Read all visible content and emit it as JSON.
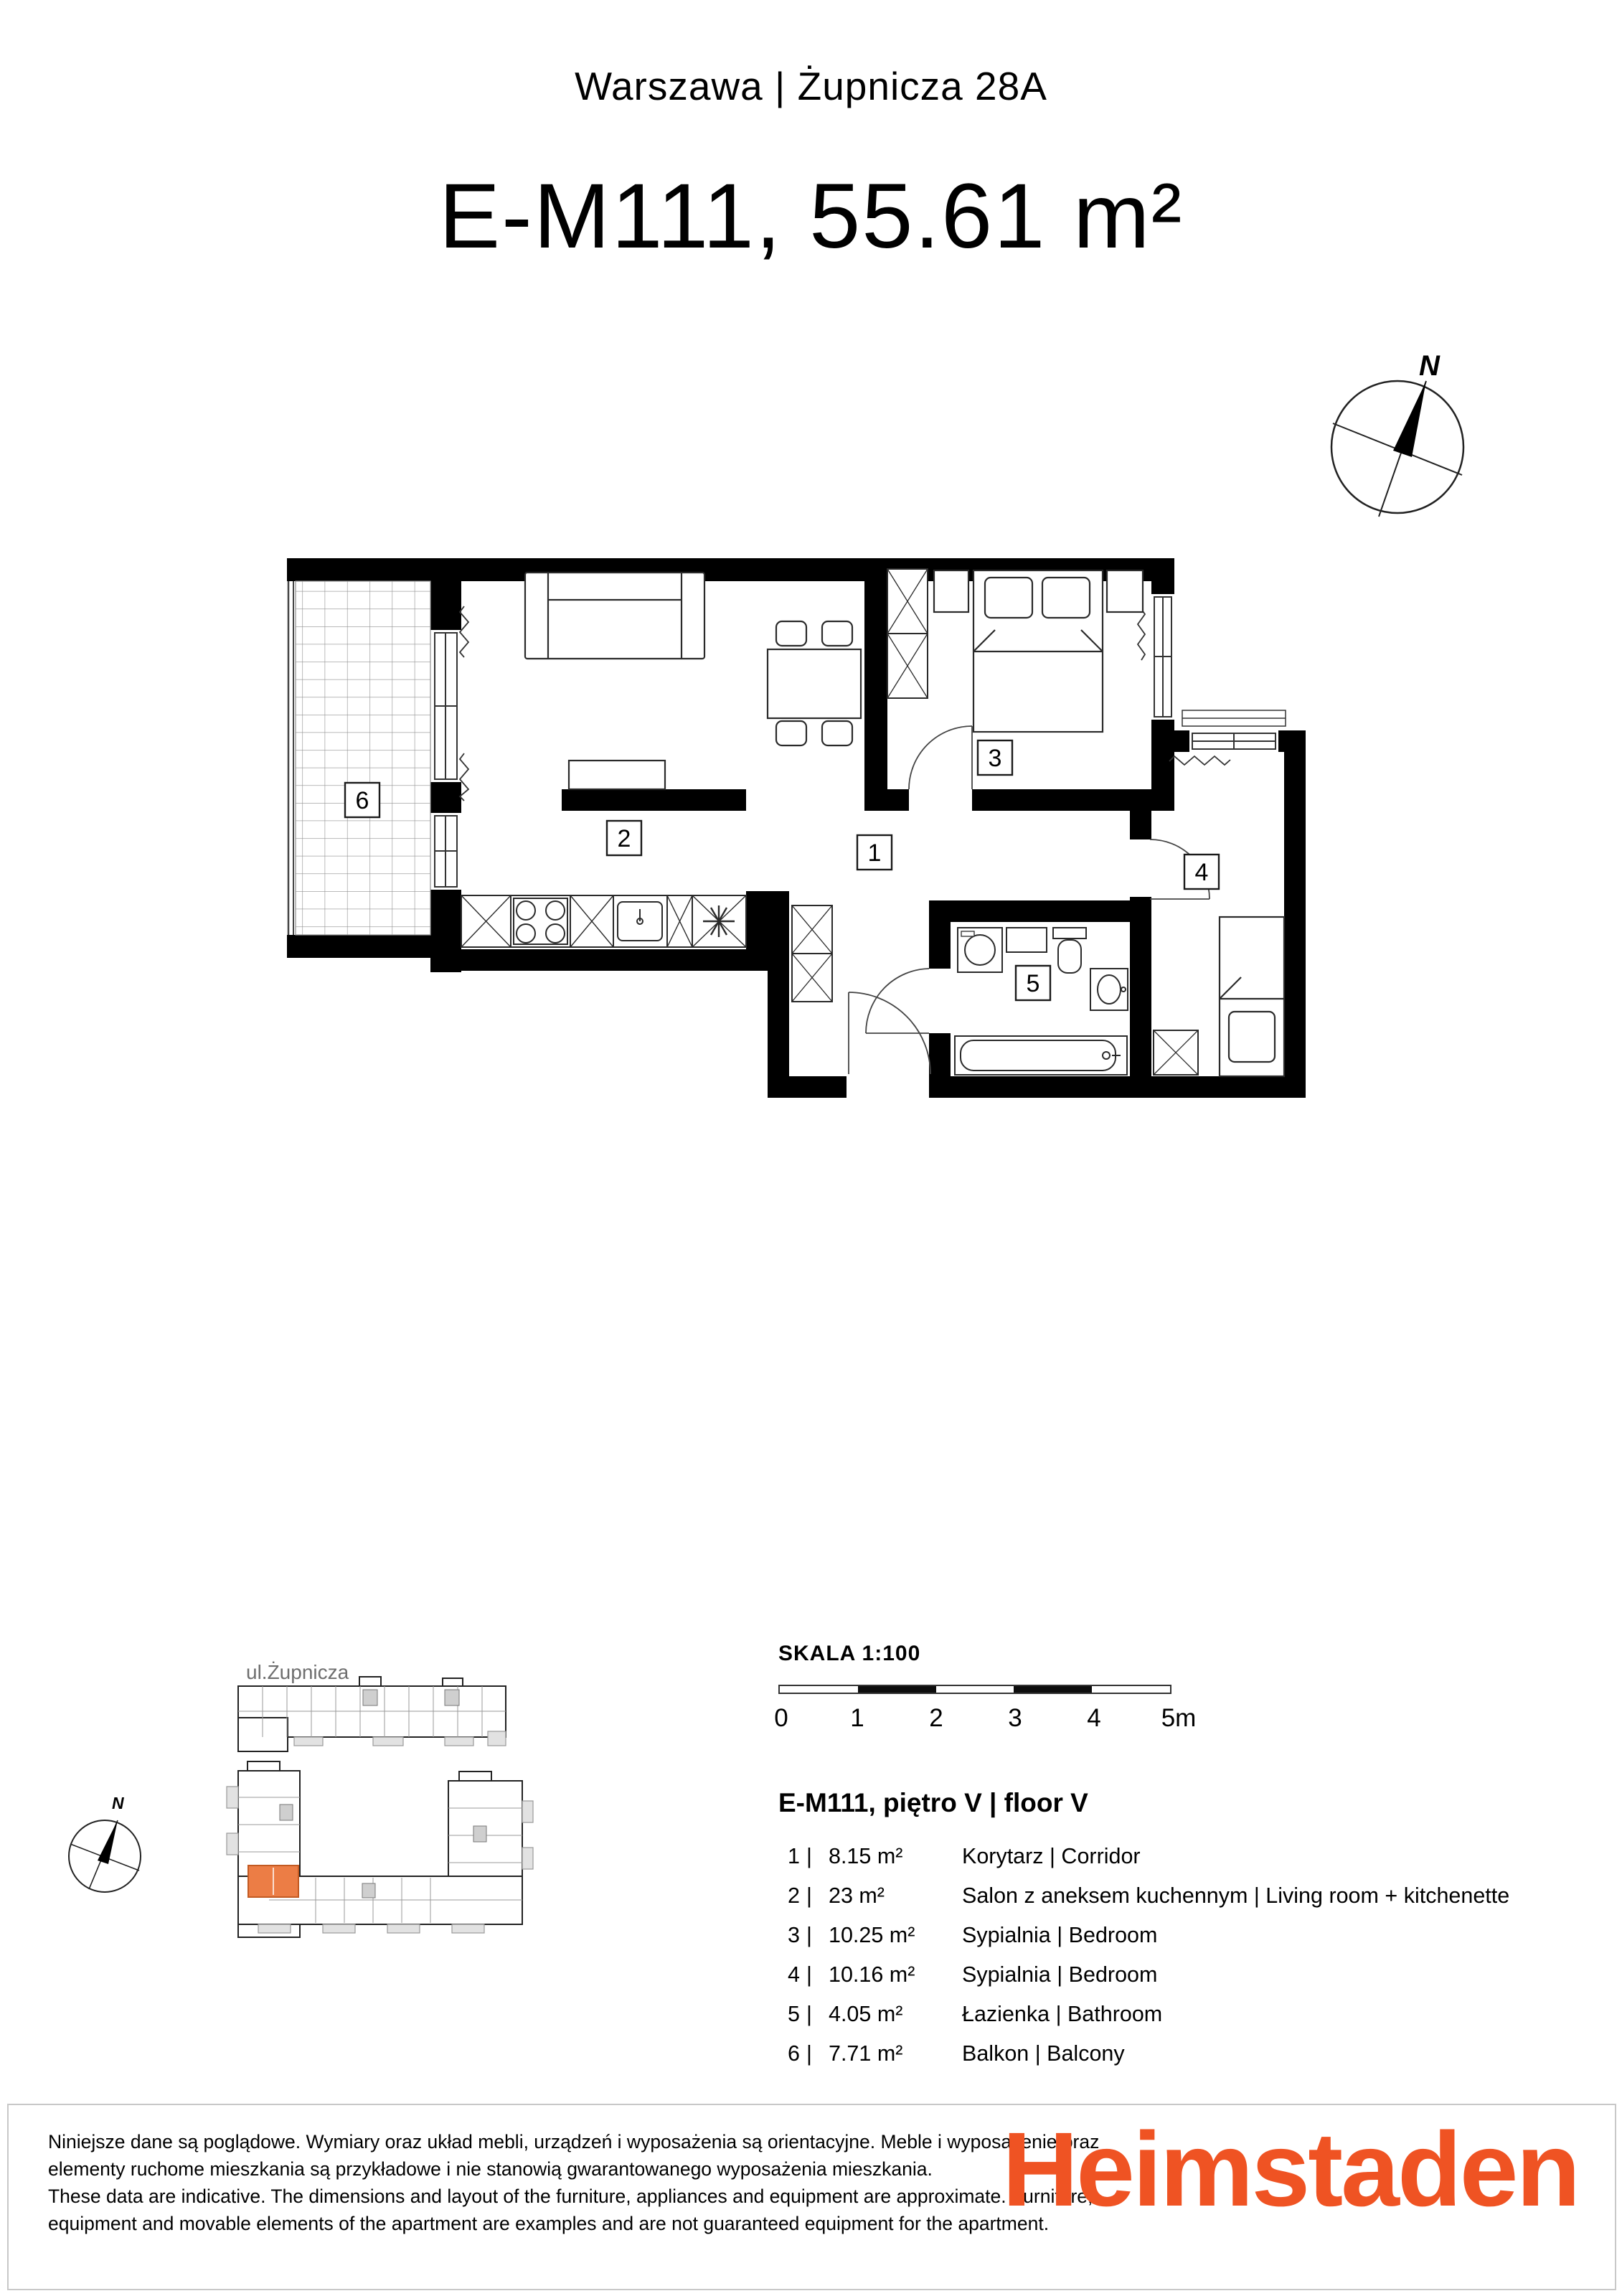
{
  "header": {
    "subtitle": "Warszawa | Żupnicza 28A",
    "title": "E-M111, 55.61 m²"
  },
  "compass": {
    "n": "N"
  },
  "plan": {
    "room_labels": [
      "1",
      "2",
      "3",
      "4",
      "5",
      "6"
    ]
  },
  "minimap": {
    "street": "ul.Żupnicza",
    "n": "N",
    "highlight_color": "#EC7D45"
  },
  "scale": {
    "title": "SKALA 1:100",
    "ticks": [
      "0",
      "1",
      "2",
      "3",
      "4",
      "5m"
    ]
  },
  "legend": {
    "heading": "E-M111, piętro V | floor V",
    "divider": "|",
    "rooms": [
      {
        "n": "1",
        "area": "8.15 m²",
        "name": "Korytarz  | Corridor"
      },
      {
        "n": "2",
        "area": "23 m²",
        "name": "Salon z aneksem kuchennym  | Living room + kitchenette"
      },
      {
        "n": "3",
        "area": "10.25 m²",
        "name": "Sypialnia | Bedroom"
      },
      {
        "n": "4",
        "area": "10.16 m²",
        "name": "Sypialnia  | Bedroom"
      },
      {
        "n": "5",
        "area": "4.05 m²",
        "name": "Łazienka  | Bathroom"
      },
      {
        "n": "6",
        "area": "7.71 m²",
        "name": "Balkon | Balcony"
      }
    ]
  },
  "footer": {
    "disclaimer": [
      "Niniejsze dane są poglądowe. Wymiary oraz układ mebli, urządzeń i wyposażenia są orientacyjne. Meble i wyposażenie oraz",
      "elementy ruchome mieszkania są przykładowe i nie stanowią gwarantowanego wyposażenia mieszkania.",
      "These data are indicative. The dimensions and layout of the furniture, appliances and equipment are approximate. Furniture,",
      "equipment and movable elements of the apartment are examples and are not guaranteed equipment for the apartment."
    ],
    "logo": "Heimstaden",
    "logo_color": "#EF5323"
  }
}
